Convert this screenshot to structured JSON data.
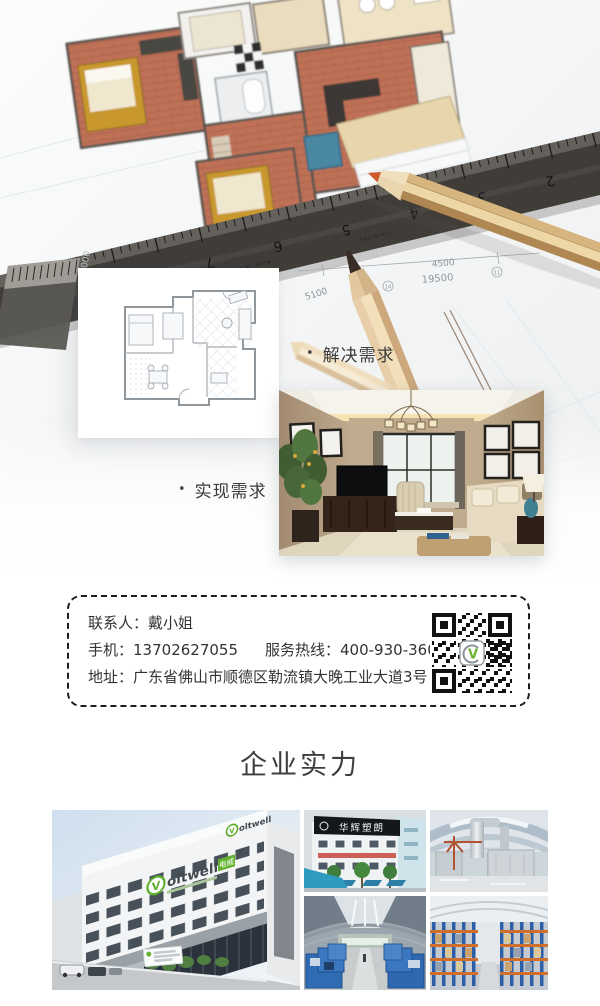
{
  "hero": {
    "solve_bullet": "•",
    "solve_label": "解决需求",
    "realize_bullet": "•",
    "realize_label": "实现需求",
    "blueprint": {
      "dim_a": "4500",
      "dim_b": "19500",
      "dim_c": "5100",
      "dim_d": "6000",
      "marker_a": "14",
      "marker_b": "11",
      "ruler_numbers": [
        "7",
        "6",
        "5",
        "4",
        "3",
        "2"
      ],
      "ruler_brand": "STAINLESS",
      "ruler_origin": "MADE IN CHINA"
    }
  },
  "contact": {
    "contact_label": "联系人：",
    "contact_name": "戴小姐",
    "phone_label": "手机：",
    "phone_number": "13702627055",
    "hotline_label": "服务热线：",
    "hotline_number": "400-930-3600",
    "address_label": "地址：",
    "address": "广东省佛山市顺德区勒流镇大晚工业大道3号"
  },
  "sections": {
    "strength_title": "企业实力"
  },
  "gallery": {
    "brand_mark": "V",
    "brand_name": "oltwell",
    "brand_box": "电威",
    "brand_reg": "®",
    "sign_huahui": "华辉塑朗"
  },
  "colors": {
    "brand_green": "#63b22f",
    "terracotta": "#bf7156",
    "ruler_dark": "#403d39",
    "accent_teal": "#4a87a2",
    "text_dark": "#333333"
  }
}
